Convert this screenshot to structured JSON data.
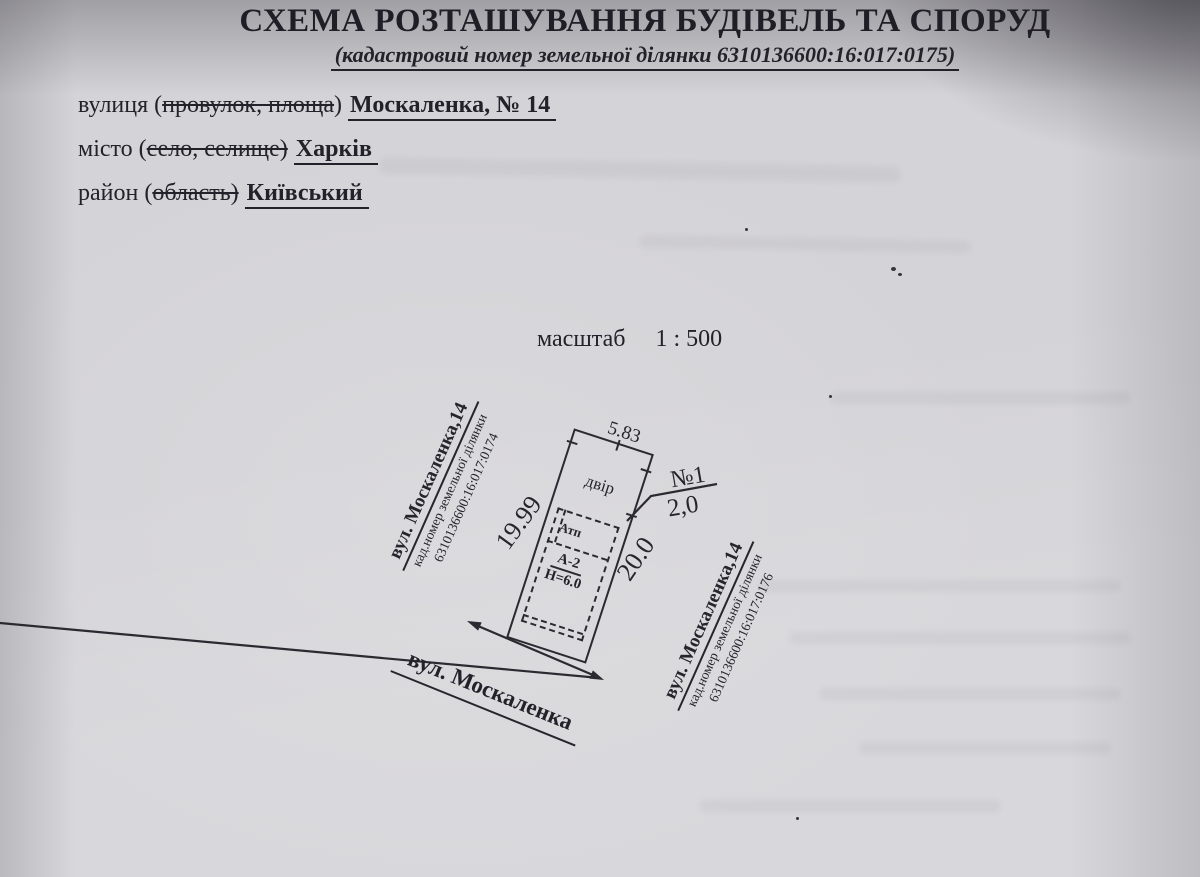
{
  "document": {
    "title": "СХЕМА РОЗТАШУВАННЯ БУДІВЕЛЬ ТА СПОРУД",
    "subtitle": "(кадастровий номер земельної ділянки 6310136600:16:017:0175)",
    "address": {
      "street": {
        "label": "вулиця (",
        "struck": "провулок, площа",
        "after": ") ",
        "value": "Москаленка, № 14"
      },
      "city": {
        "label": "місто (",
        "struck": "село, селище)",
        "after": " ",
        "value": "Харків"
      },
      "district": {
        "label": "район (",
        "struck": "область)",
        "after": " ",
        "value": "Київський"
      }
    },
    "scale_label": "масштаб",
    "scale_value": "1 : 500"
  },
  "plan": {
    "dim_top": "5.83",
    "dim_left": "19.99",
    "dim_right": "20.0",
    "yard_label": "двір",
    "atp_label": "Атп",
    "building_code": "А-2",
    "building_height": "Н=6.0",
    "plot_number": "№1",
    "entrance_width": "2,0",
    "left_parcel": {
      "line1": "вул. Москаленка,14",
      "line2": "кад.номер земельної ділянки",
      "line3": "6310136600:16:017:0174"
    },
    "right_parcel": {
      "line1": "вул. Москаленка,14",
      "line2": "кад.номер земельної ділянки",
      "line3": "6310136600:16:017:0176"
    },
    "street_label": "вул. Москаленка"
  },
  "colors": {
    "ink": "#23222a",
    "paper": "#d4d3d7"
  }
}
